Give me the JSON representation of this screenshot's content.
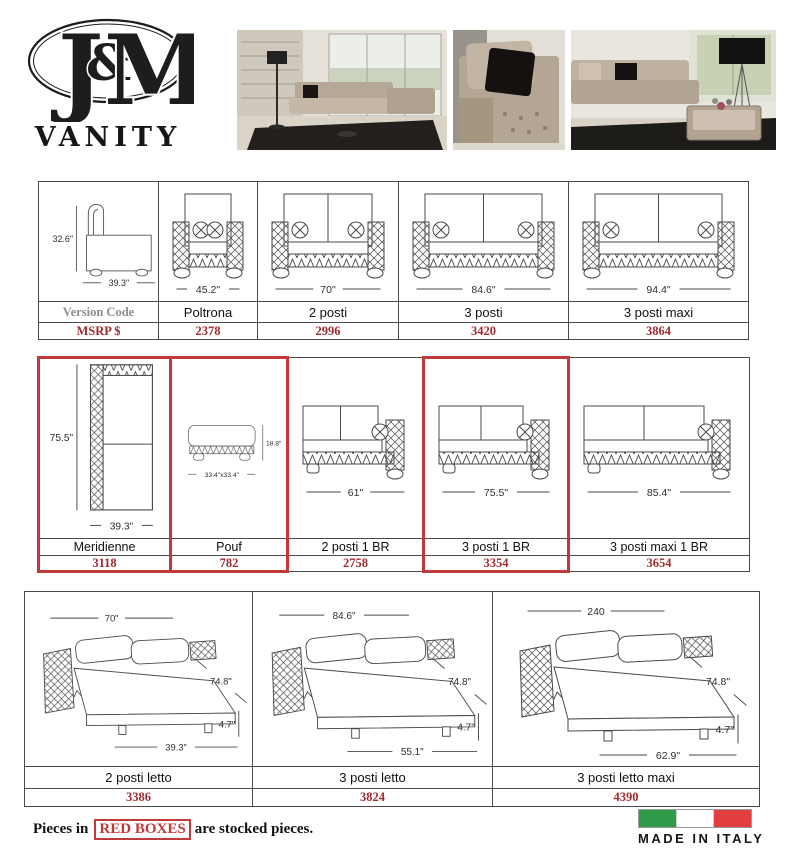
{
  "brand": {
    "logo_j": "J",
    "logo_amp": "&",
    "logo_m": "M",
    "collection": "VANITY"
  },
  "photos": [
    {
      "name": "living-room-sectional-photo"
    },
    {
      "name": "armchair-closeup-photo"
    },
    {
      "name": "sofa-lamp-table-photo"
    }
  ],
  "table1": {
    "columns": [
      {
        "label": "Version Code",
        "msrp": "MSRP $",
        "diagram": {
          "type": "side",
          "height": "32.6\"",
          "width": "39.3\""
        }
      },
      {
        "label": "Poltrona",
        "msrp": "2378",
        "diagram": {
          "type": "front",
          "seats": 1,
          "width": "45.2\""
        }
      },
      {
        "label": "2 posti",
        "msrp": "2996",
        "diagram": {
          "type": "front",
          "seats": 2,
          "width": "70\""
        }
      },
      {
        "label": "3 posti",
        "msrp": "3420",
        "diagram": {
          "type": "front",
          "seats": 2,
          "width": "84.6\""
        }
      },
      {
        "label": "3 posti maxi",
        "msrp": "3864",
        "diagram": {
          "type": "front",
          "seats": 2,
          "width": "94.4\""
        }
      }
    ]
  },
  "table2": {
    "columns": [
      {
        "label": "Meridienne",
        "msrp": "3118",
        "stocked": true,
        "diagram": {
          "type": "top",
          "height": "75.5\"",
          "width": "39.3\""
        }
      },
      {
        "label": "Pouf",
        "msrp": "782",
        "stocked": true,
        "diagram": {
          "type": "pouf",
          "height": "18.8\"",
          "width": "33.4\"x33.4\""
        }
      },
      {
        "label": "2 posti 1 BR",
        "msrp": "2758",
        "stocked": false,
        "diagram": {
          "type": "chaise",
          "width": "61\""
        }
      },
      {
        "label": "3 posti 1 BR",
        "msrp": "3354",
        "stocked": true,
        "diagram": {
          "type": "chaise",
          "width": "75.5\""
        }
      },
      {
        "label": "3 posti maxi 1 BR",
        "msrp": "3654",
        "stocked": false,
        "diagram": {
          "type": "chaise",
          "width": "85.4\""
        }
      }
    ]
  },
  "table3": {
    "columns": [
      {
        "label": "2 posti letto",
        "msrp": "3386",
        "diagram": {
          "type": "bed",
          "top": "70\"",
          "depth": "74.8\"",
          "leg": "4.7\"",
          "front": "39.3\""
        }
      },
      {
        "label": "3 posti letto",
        "msrp": "3824",
        "diagram": {
          "type": "bed",
          "top": "84.6\"",
          "depth": "74.8\"",
          "leg": "4.7\"",
          "front": "55.1\""
        }
      },
      {
        "label": "3 posti letto maxi",
        "msrp": "4390",
        "diagram": {
          "type": "bed",
          "top": "240",
          "depth": "74.8\"",
          "leg": "4.7\"",
          "front": "62.9\""
        }
      }
    ]
  },
  "footer": {
    "prefix": "Pieces in",
    "highlight": "RED BOXES",
    "suffix": "are stocked pieces.",
    "made_in": "MADE IN ITALY"
  },
  "colors": {
    "stock_box_red": "#c0393b",
    "msrp_red": "#9e2b2f",
    "flag_green": "#2f9a48",
    "flag_red": "#e23d41",
    "line_art": "#4a4a4a"
  }
}
